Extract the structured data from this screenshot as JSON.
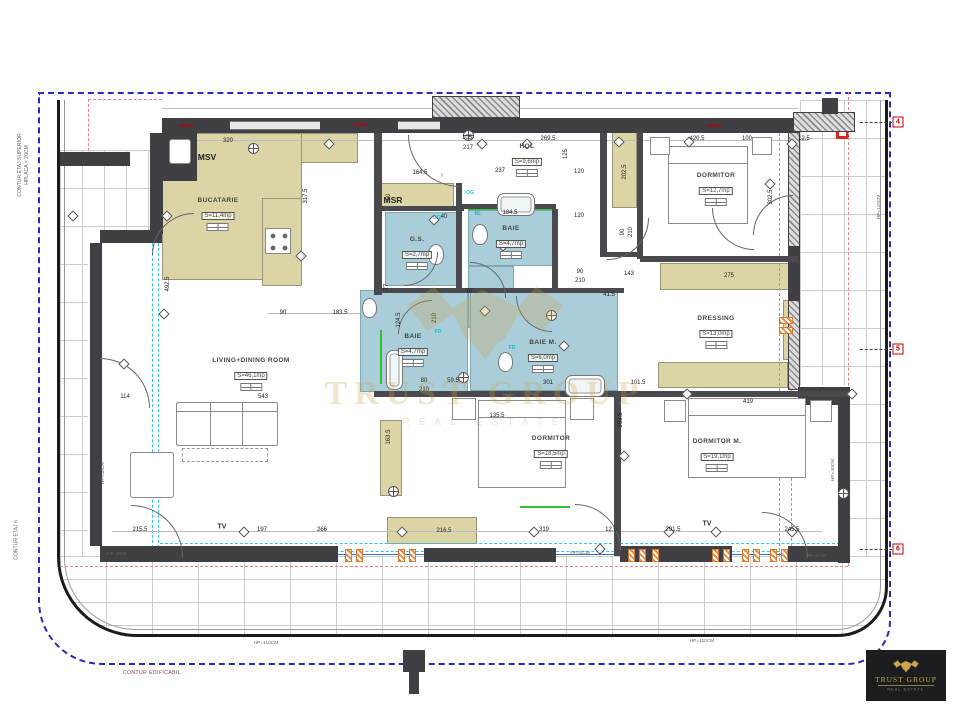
{
  "plan": {
    "rooms": [
      {
        "name": "BUCATARIE",
        "area": "S=11,4mp",
        "x": 218,
        "y": 202
      },
      {
        "name": "MSV",
        "area": "",
        "x": 207,
        "y": 157
      },
      {
        "name": "MSR",
        "area": "",
        "x": 393,
        "y": 200
      },
      {
        "name": "HOL",
        "area": "S=9,6mp",
        "x": 527,
        "y": 148
      },
      {
        "name": "G.S.",
        "area": "S=2,7mp",
        "x": 417,
        "y": 241
      },
      {
        "name": "BAIE",
        "area": "S=4,7mp",
        "x": 511,
        "y": 230
      },
      {
        "name": "BAIE",
        "area": "S=4,7mp",
        "x": 413,
        "y": 338
      },
      {
        "name": "BAIE M.",
        "area": "S=6,0mp",
        "x": 543,
        "y": 344
      },
      {
        "name": "DORMITOR",
        "area": "S=12,7mp",
        "x": 716,
        "y": 177
      },
      {
        "name": "DRESSING",
        "area": "S=13,0mp",
        "x": 716,
        "y": 320
      },
      {
        "name": "DORMITOR",
        "area": "S=18,5mp",
        "x": 551,
        "y": 440
      },
      {
        "name": "DORMITOR M.",
        "area": "S=19,1mp",
        "x": 717,
        "y": 443
      },
      {
        "name": "LIVING+DINING ROOM",
        "area": "S=46,1mp",
        "x": 251,
        "y": 362
      }
    ],
    "dimensions": [
      {
        "t": "320",
        "x": 228,
        "y": 141
      },
      {
        "t": "105",
        "x": 467,
        "y": 138
      },
      {
        "t": "217",
        "x": 468,
        "y": 148
      },
      {
        "t": "269.5",
        "x": 548,
        "y": 139
      },
      {
        "t": "420.5",
        "x": 697,
        "y": 139
      },
      {
        "t": "100",
        "x": 747,
        "y": 139
      },
      {
        "t": "12.5",
        "x": 804,
        "y": 139
      },
      {
        "t": "164.5",
        "x": 420,
        "y": 173
      },
      {
        "t": "237",
        "x": 500,
        "y": 171
      },
      {
        "t": "120",
        "x": 579,
        "y": 172
      },
      {
        "t": "125",
        "x": 566,
        "y": 154,
        "v": 1
      },
      {
        "t": "60",
        "x": 389,
        "y": 197,
        "v": 1
      },
      {
        "t": "77",
        "x": 387,
        "y": 287,
        "v": 1
      },
      {
        "t": "184.5",
        "x": 510,
        "y": 213
      },
      {
        "t": "120",
        "x": 579,
        "y": 216
      },
      {
        "t": "40",
        "x": 444,
        "y": 217
      },
      {
        "t": "90",
        "x": 580,
        "y": 272
      },
      {
        "t": "210",
        "x": 580,
        "y": 281
      },
      {
        "t": "41.5",
        "x": 609,
        "y": 295
      },
      {
        "t": "143",
        "x": 629,
        "y": 274
      },
      {
        "t": "275",
        "x": 729,
        "y": 276
      },
      {
        "t": "70",
        "x": 469,
        "y": 292
      },
      {
        "t": "90",
        "x": 283,
        "y": 313
      },
      {
        "t": "183.5",
        "x": 340,
        "y": 313
      },
      {
        "t": "317.5",
        "x": 306,
        "y": 196,
        "v": 1
      },
      {
        "t": "202.5",
        "x": 625,
        "y": 172,
        "v": 1
      },
      {
        "t": "302.5",
        "x": 771,
        "y": 197,
        "v": 1
      },
      {
        "t": "492.5",
        "x": 168,
        "y": 284,
        "v": 1
      },
      {
        "t": "114",
        "x": 125,
        "y": 397
      },
      {
        "t": "543",
        "x": 263,
        "y": 397
      },
      {
        "t": "101.5",
        "x": 638,
        "y": 383
      },
      {
        "t": "419",
        "x": 748,
        "y": 402
      },
      {
        "t": "135.5",
        "x": 497,
        "y": 416
      },
      {
        "t": "553.5",
        "x": 621,
        "y": 420,
        "v": 1
      },
      {
        "t": "163.5",
        "x": 389,
        "y": 437,
        "v": 1
      },
      {
        "t": "124.5",
        "x": 399,
        "y": 320,
        "v": 1
      },
      {
        "t": "80",
        "x": 424,
        "y": 381
      },
      {
        "t": "210",
        "x": 424,
        "y": 390
      },
      {
        "t": "59.5",
        "x": 453,
        "y": 381
      },
      {
        "t": "301",
        "x": 548,
        "y": 383
      },
      {
        "t": "215.5",
        "x": 140,
        "y": 530
      },
      {
        "t": "197",
        "x": 262,
        "y": 530
      },
      {
        "t": "266",
        "x": 322,
        "y": 530
      },
      {
        "t": "216.5",
        "x": 444,
        "y": 531
      },
      {
        "t": "319",
        "x": 544,
        "y": 530
      },
      {
        "t": "12.5",
        "x": 611,
        "y": 530
      },
      {
        "t": "291.5",
        "x": 673,
        "y": 530
      },
      {
        "t": "245.5",
        "x": 792,
        "y": 530
      },
      {
        "t": "210",
        "x": 435,
        "y": 318,
        "v": 1
      },
      {
        "t": "90",
        "x": 623,
        "y": 232,
        "v": 1
      },
      {
        "t": "210",
        "x": 631,
        "y": 232,
        "v": 1
      }
    ],
    "labels": [
      {
        "cls": "tv",
        "text": "TV",
        "x": 222,
        "y": 527
      },
      {
        "cls": "tv",
        "text": "TV",
        "x": 707,
        "y": 524
      },
      {
        "cls": "cyan",
        "text": "OG",
        "x": 470,
        "y": 193
      },
      {
        "cls": "cyan",
        "text": "OG",
        "x": 437,
        "y": 218
      },
      {
        "cls": "cyan",
        "text": "BL",
        "x": 478,
        "y": 214
      },
      {
        "cls": "cyan",
        "text": "FD",
        "x": 438,
        "y": 332
      },
      {
        "cls": "cyan",
        "text": "FD",
        "x": 512,
        "y": 348
      },
      {
        "cls": "red",
        "text": "RE100",
        "x": 186,
        "y": 126
      },
      {
        "cls": "red",
        "text": "RE100",
        "x": 360,
        "y": 125
      },
      {
        "cls": "red",
        "text": "RE100",
        "x": 714,
        "y": 126
      },
      {
        "cls": "hp",
        "text": "HP=110CM",
        "x": 266,
        "y": 643
      },
      {
        "cls": "hp",
        "text": "HP=110CM",
        "x": 702,
        "y": 641
      },
      {
        "cls": "hpv",
        "text": "HP=110CM",
        "x": 879,
        "y": 207
      },
      {
        "cls": "hpv",
        "text": "HP=40CM",
        "x": 103,
        "y": 473
      },
      {
        "cls": "hpv",
        "text": "HP=40CM",
        "x": 833,
        "y": 470
      },
      {
        "cls": "hp",
        "text": "HP=0CM",
        "x": 117,
        "y": 554
      },
      {
        "cls": "hp",
        "text": "HP=0CM",
        "x": 580,
        "y": 553
      },
      {
        "cls": "hp",
        "text": "HP=0CM",
        "x": 816,
        "y": 556
      },
      {
        "cls": "arrow",
        "text": "↑",
        "x": 442,
        "y": 176
      }
    ],
    "grid_markers": [
      {
        "n": "4",
        "x": 898,
        "y": 122
      },
      {
        "n": "5",
        "x": 898,
        "y": 349
      },
      {
        "n": "6",
        "x": 898,
        "y": 549
      }
    ],
    "apt_table": {
      "row1": "APT NR.",
      "row2": "TIP",
      "row3": "SC = 173.5MP"
    },
    "contours": {
      "bottom": "CONTUR EDIFICABIL",
      "left_top": "CONTUR ETAJ SUPERIOR\nHPLACA = 20CM",
      "left_bottom": "CONTUR ETAJ 6"
    }
  },
  "branding": {
    "watermark": {
      "title": "TRUST GROUP",
      "subtitle": "REAL ESTATE"
    },
    "logo": {
      "title": "TRUST GROUP",
      "subtitle": "REAL ESTATE"
    },
    "gold": "#c9a54b",
    "accent_blue": "#2b2bb8",
    "accent_cyan": "#35c8dc",
    "accent_red": "#c00000"
  }
}
